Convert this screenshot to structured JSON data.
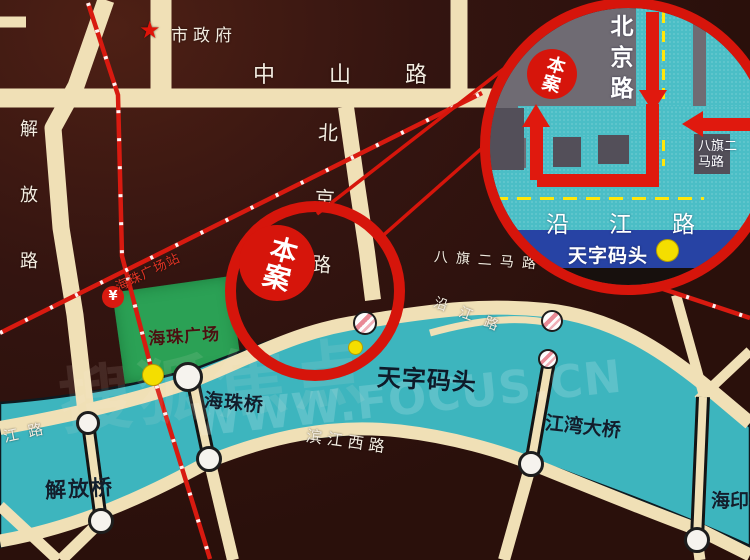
{
  "colors": {
    "background": "#2f130d",
    "road": "#f0e0b6",
    "river": "#3db5be",
    "metro_red": "#d81a10",
    "ring_red": "#d6150b",
    "square_green": "#2ba155",
    "inset_background": "#6f6b73",
    "inset_road_teal": "#4bbec6",
    "inset_river_blue": "#2743a4",
    "marker_yellow": "#f4de00",
    "dark_label": "#121e2c"
  },
  "icons": {
    "city_hall_star": "★",
    "metro_logo_glyph": "¥"
  },
  "main_map": {
    "poi": {
      "city_hall": "市政府",
      "haizhu_square": "海珠广场",
      "haizhu_square_station": "海珠广场站",
      "tianzi_wharf": "天字码头",
      "site": "本案"
    },
    "roads": {
      "zhongshan_road": "中山路",
      "jiefang_road": "解放路",
      "beijing_road": "北京路",
      "baqi_erma_road": "八旗二马路",
      "yanjiang_road": "沿江路",
      "yanjiang_road_partial": "江路",
      "binjiang_west_road": "滨江西路"
    },
    "bridges": {
      "jiefang_bridge": "解放桥",
      "haizhu_bridge": "海珠桥",
      "jiangwan_bridge": "江湾大桥",
      "haiyin_bridge": "海印桥"
    }
  },
  "inset": {
    "roads": {
      "beijing_road": "北京路",
      "yanjiang_road": "沿江路",
      "baqi_erma_road_line1": "八旗二",
      "baqi_erma_road_line2": "马路"
    },
    "poi": {
      "site": "本案",
      "tianzi_wharf": "天字码头"
    }
  },
  "watermark": {
    "site_url": "WWW.FOCUS.CN",
    "brand": "搜狐焦点"
  }
}
